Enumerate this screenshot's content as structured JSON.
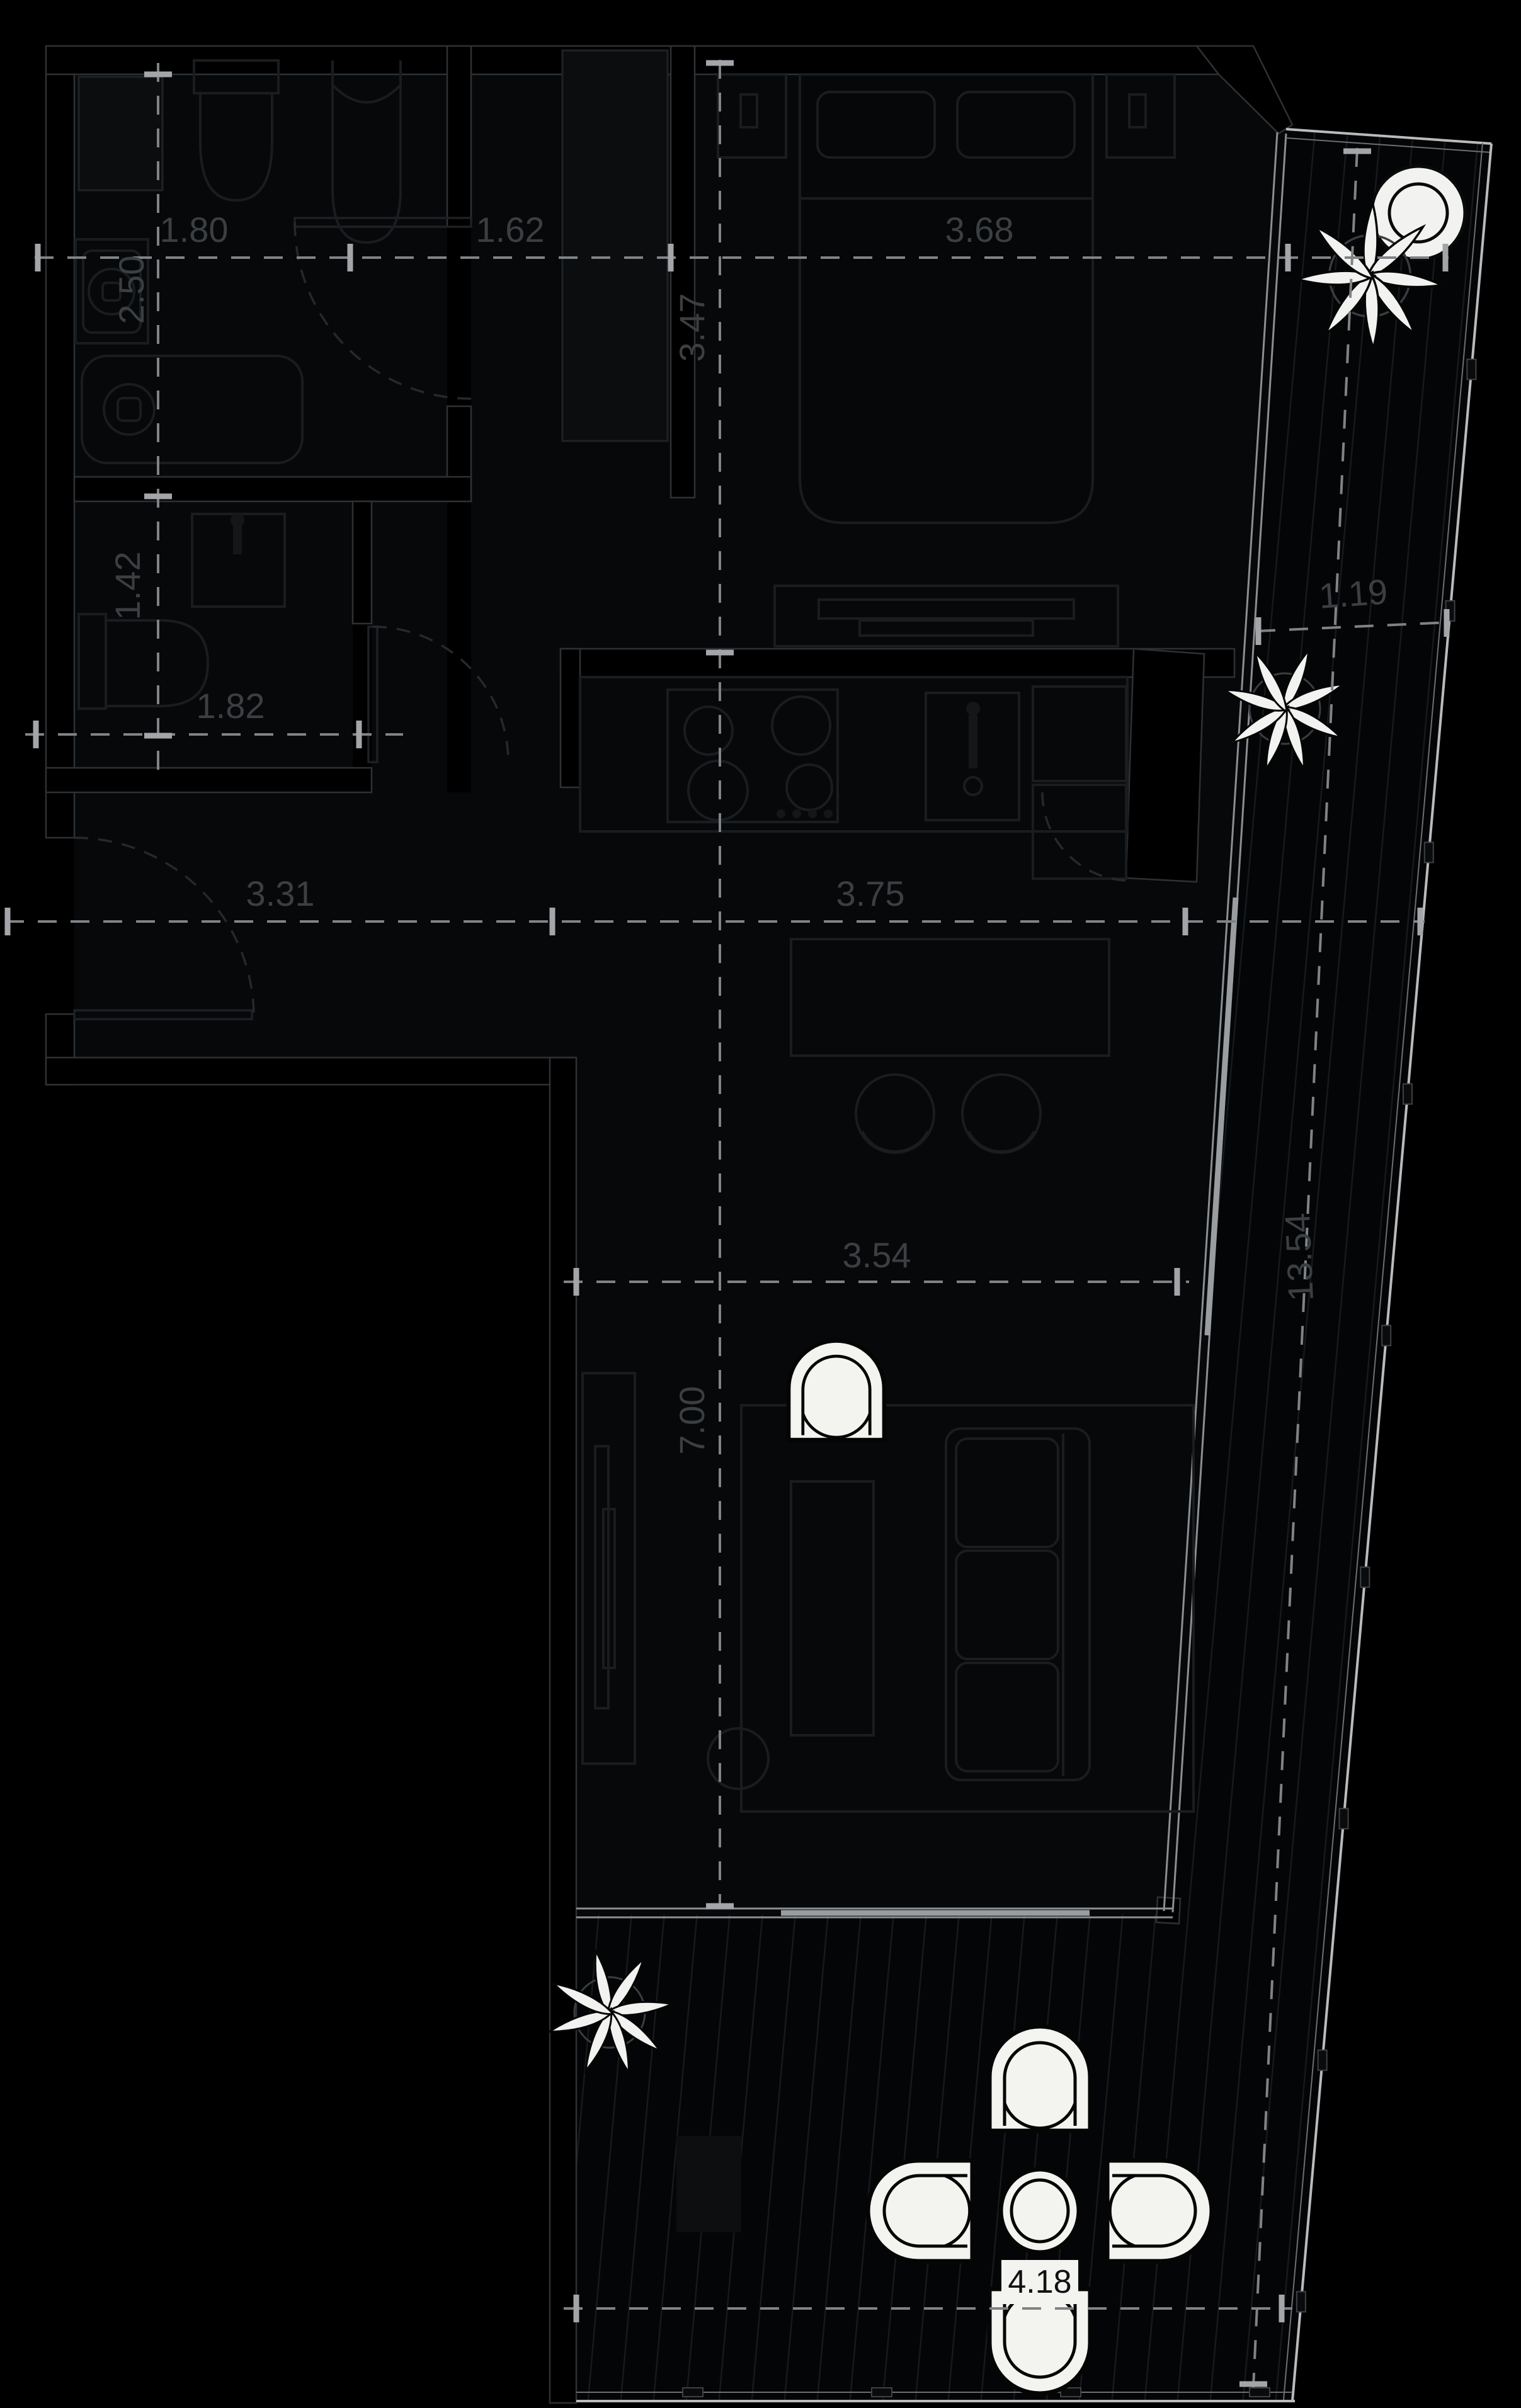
{
  "title": "apartment-floor-plan",
  "colors": {
    "background": "#000000",
    "wall_stroke": "#2e3134",
    "furniture_line": "#1a1d1f",
    "dimension_line": "#808386",
    "dimension_text": "#3c3f42",
    "white_furniture": "#f3f3f0",
    "balcony_edge": "#b9bbbd",
    "open_slider": "#9a9da0"
  },
  "dimensions": {
    "bath_width": "1.80",
    "hall_top": "1.62",
    "bedroom_width": "3.68",
    "bath_depth": "2.50",
    "bedroom_depth": "3.47",
    "wc_depth": "1.42",
    "wc_width": "1.82",
    "hall_width": "3.31",
    "kitchen_width": "3.75",
    "balcony_width": "1.19",
    "balcony_length": "13.54",
    "living_width": "3.54",
    "living_depth": "7.00",
    "terrace_width": "4.18"
  }
}
